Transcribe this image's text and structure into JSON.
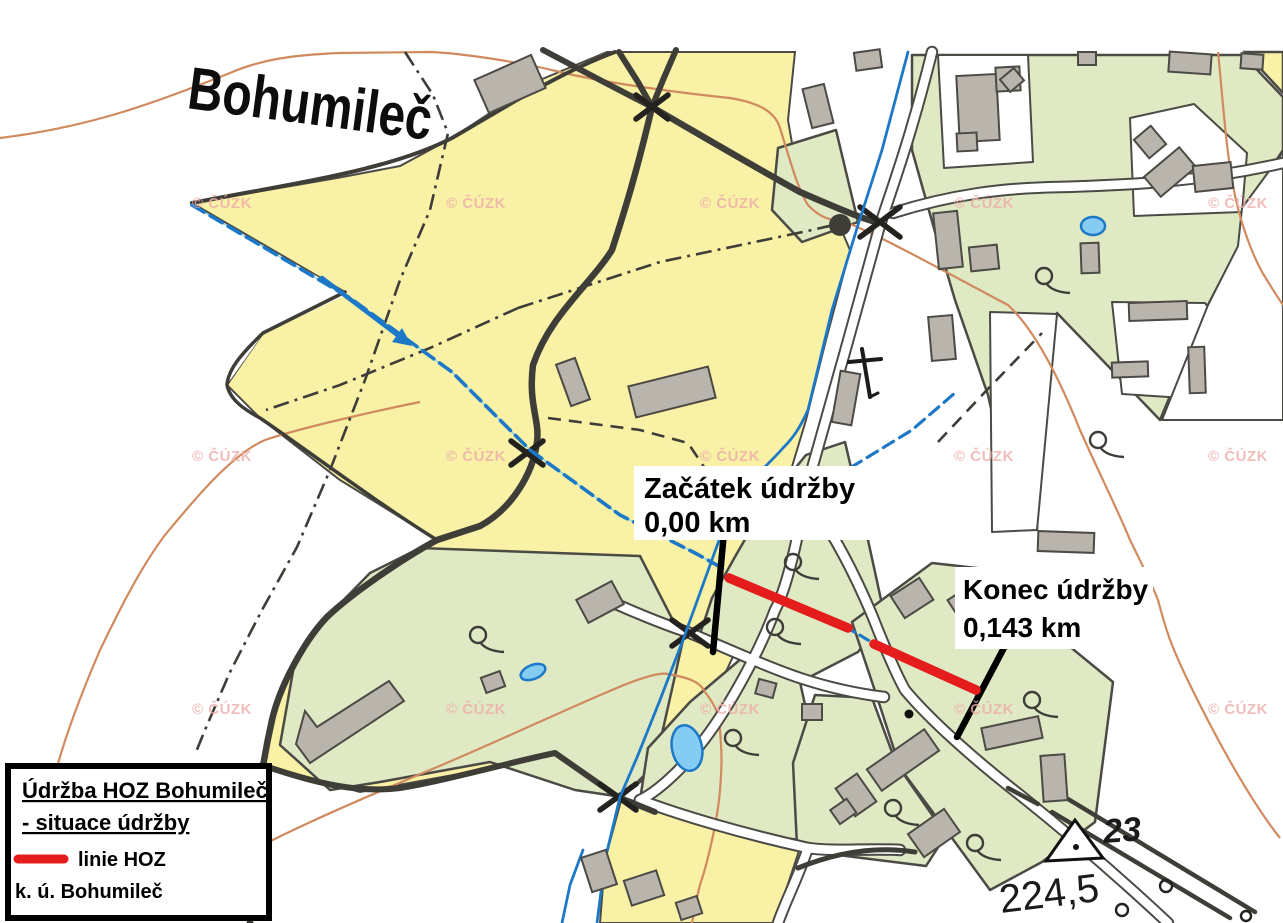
{
  "map": {
    "town_label": "Bohumileč",
    "start_marker": {
      "line1": "Začátek údržby",
      "line2": "0,00 km"
    },
    "end_marker": {
      "line1": "Konec údržby",
      "line2": "0,143 km"
    },
    "trig_point_number": "23",
    "spot_elevation": "224,5",
    "watermark": "© ČÚZK",
    "colors": {
      "field_yellow": "#f8f1a6",
      "meadow_green": "#dfe9c3",
      "building_gray": "#b9b5ac",
      "road_dark": "#3f3d38",
      "stream_blue": "#1d79c7",
      "pond_fill": "#85ccf2",
      "contour_orange": "#d08a5f",
      "hoz_red": "#e51c1c",
      "watermark_pink": "#eeadab"
    }
  },
  "legend": {
    "title_line1": "Údržba HOZ Bohumileč",
    "title_line2": "- situace údržby",
    "line_symbol_label": "linie HOZ",
    "cadastral_area": "k. ú. Bohumileč"
  }
}
